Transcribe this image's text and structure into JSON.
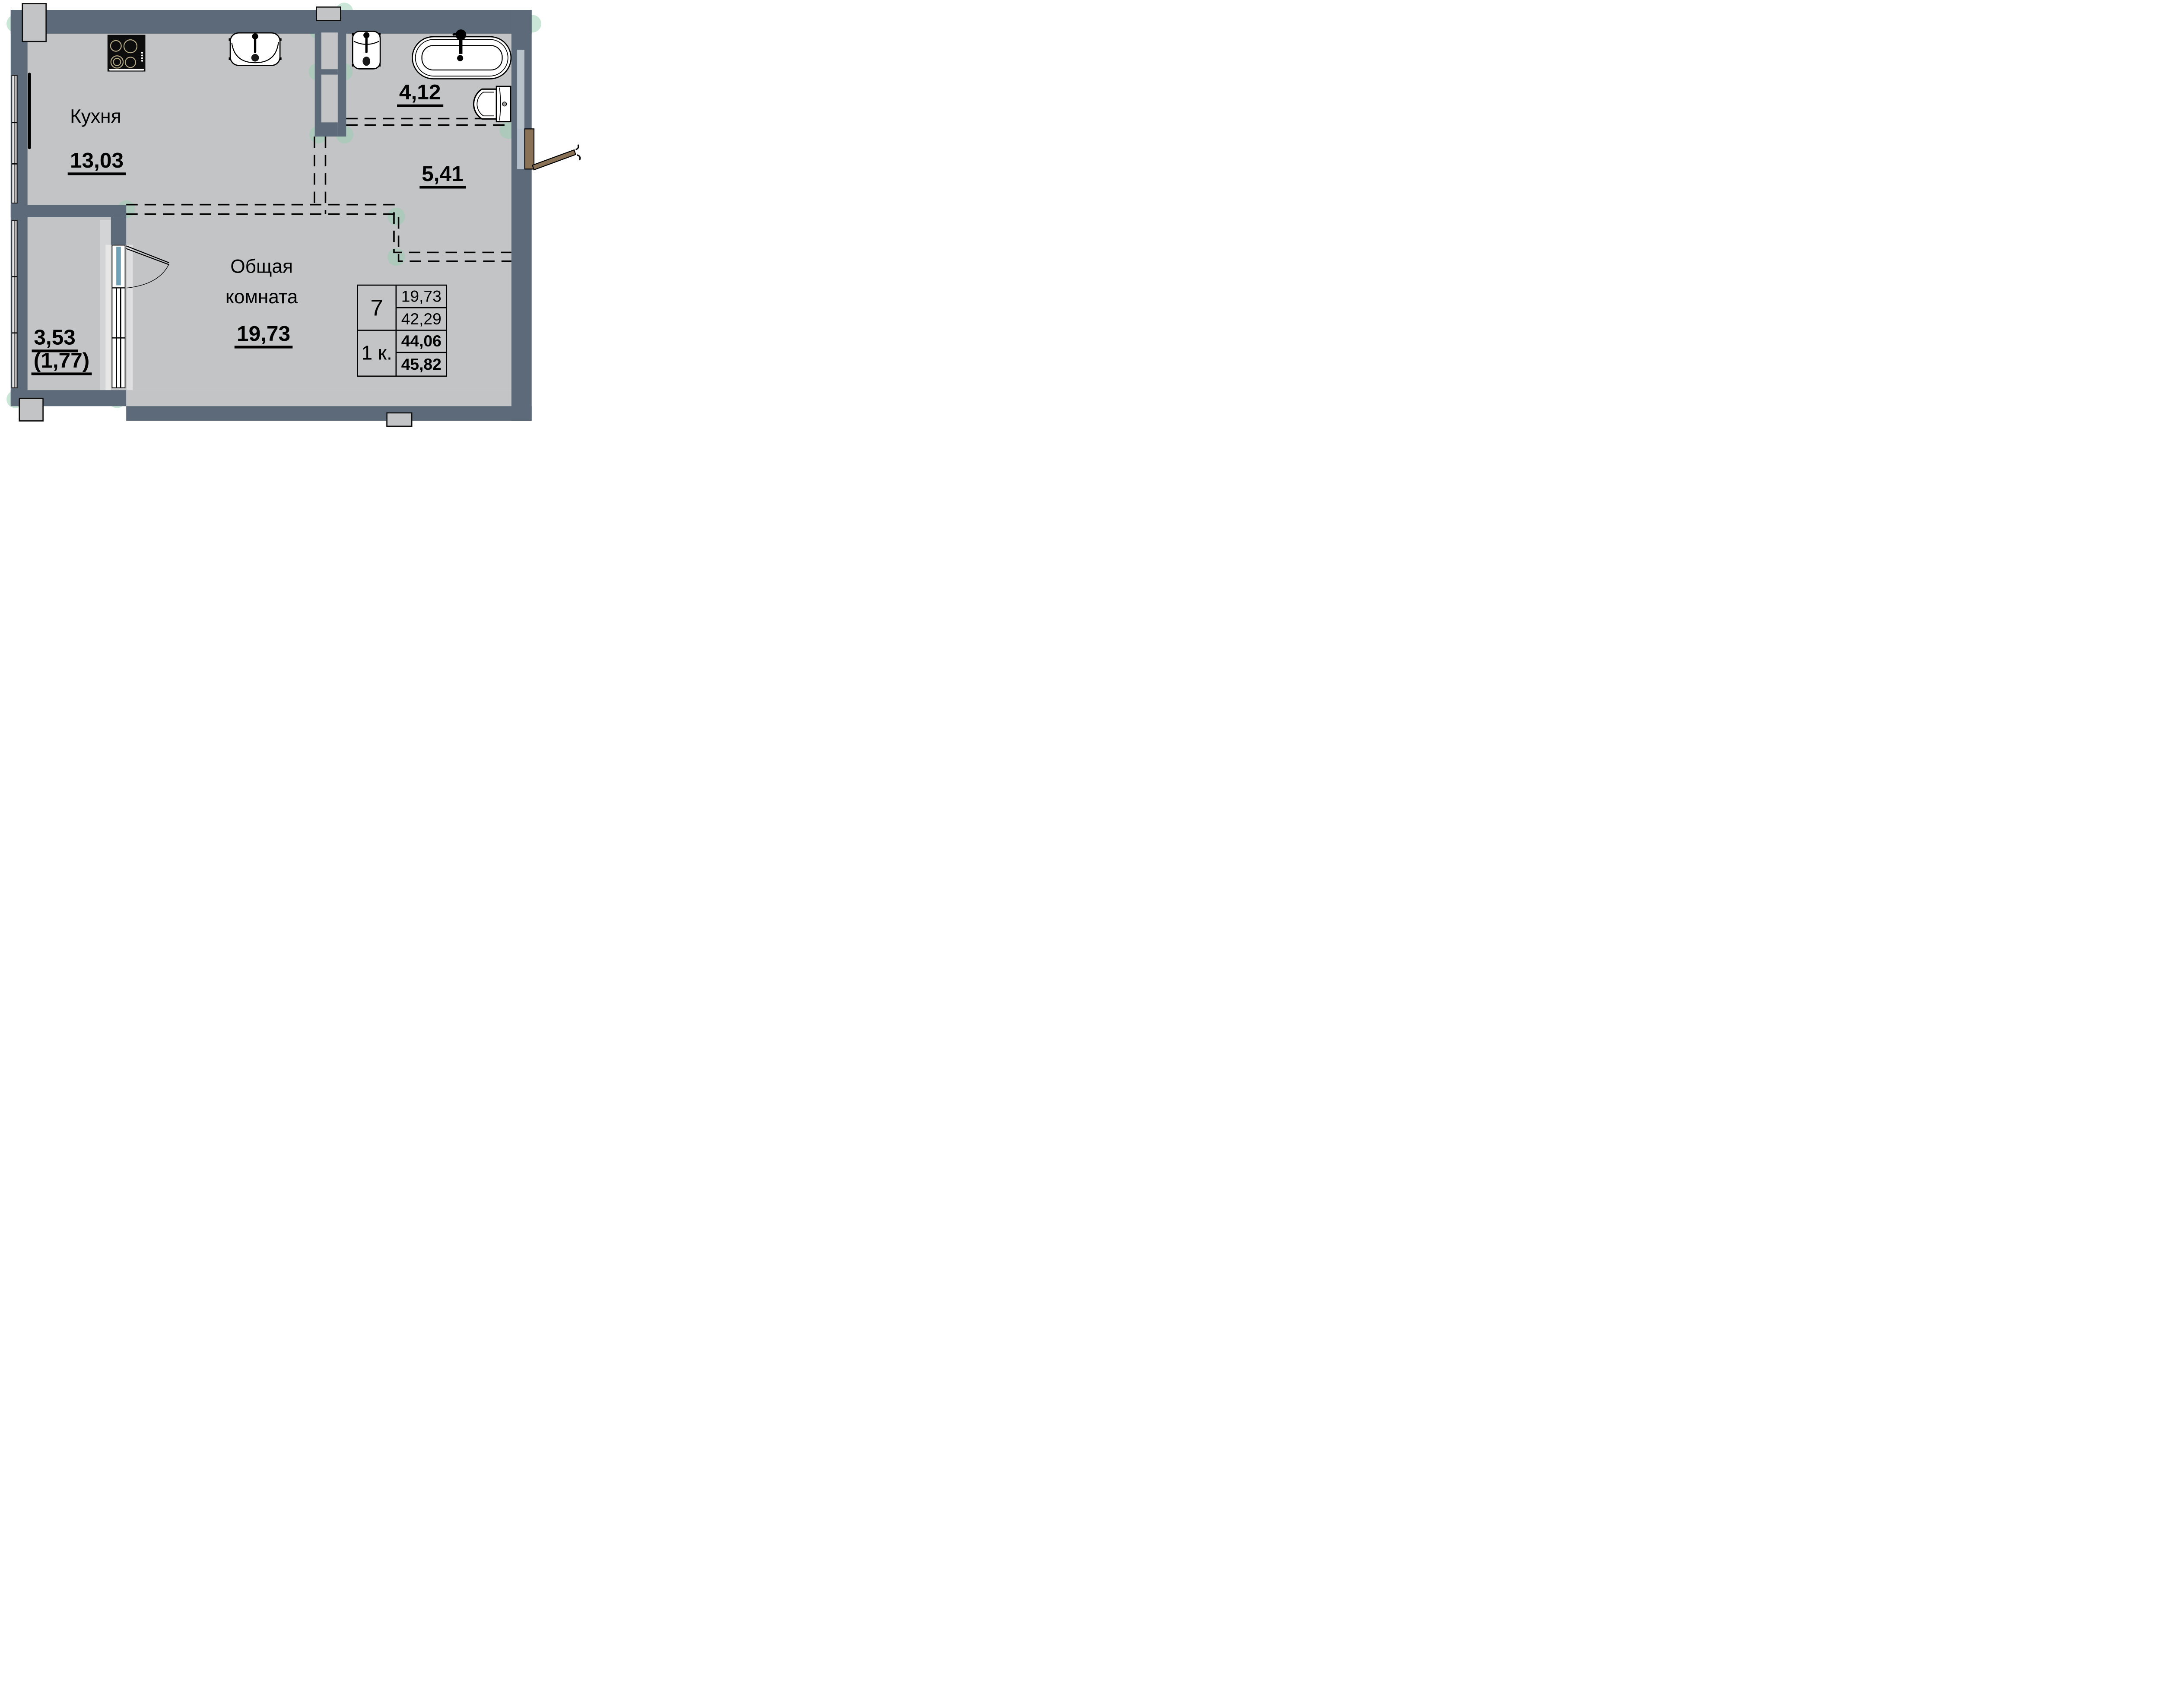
{
  "title": "Apartment floor plan, 1-room flat",
  "rooms": {
    "kitchen": {
      "name": "Кухня",
      "area": "13,03"
    },
    "bathroom": {
      "area": "4,12"
    },
    "hallway": {
      "area": "5,41"
    },
    "living": {
      "name_line1": "Общая",
      "name_line2": "комната",
      "area": "19,73"
    },
    "balcony": {
      "area": "3,53",
      "area_coefficient": "(1,77)"
    }
  },
  "info_table": {
    "flat_number": "7",
    "flat_type": "1 к.",
    "living_area": "19,73",
    "total_area": "42,29",
    "area_with_coefficient": "44,06",
    "area_full": "45,82"
  },
  "colors": {
    "wall": "#5c6a79",
    "floor": "#c3c4c6",
    "background": "#ffffff",
    "marker_green": "#96cdaf",
    "door_wood": "#8a7256",
    "glass_blue": "#6fa0b6",
    "wall_channel": "#b8c2cb",
    "burner_ring": "#b2a785",
    "outline_black": "#000000"
  },
  "icons": {
    "fixtures": [
      "stove-icon",
      "kitchen-sink-icon",
      "bathroom-sink-icon",
      "bathtub-icon",
      "toilet-icon",
      "radiator-icon",
      "entry-door-icon",
      "balcony-door-icon",
      "window-icon",
      "survey-marker-icon"
    ]
  }
}
